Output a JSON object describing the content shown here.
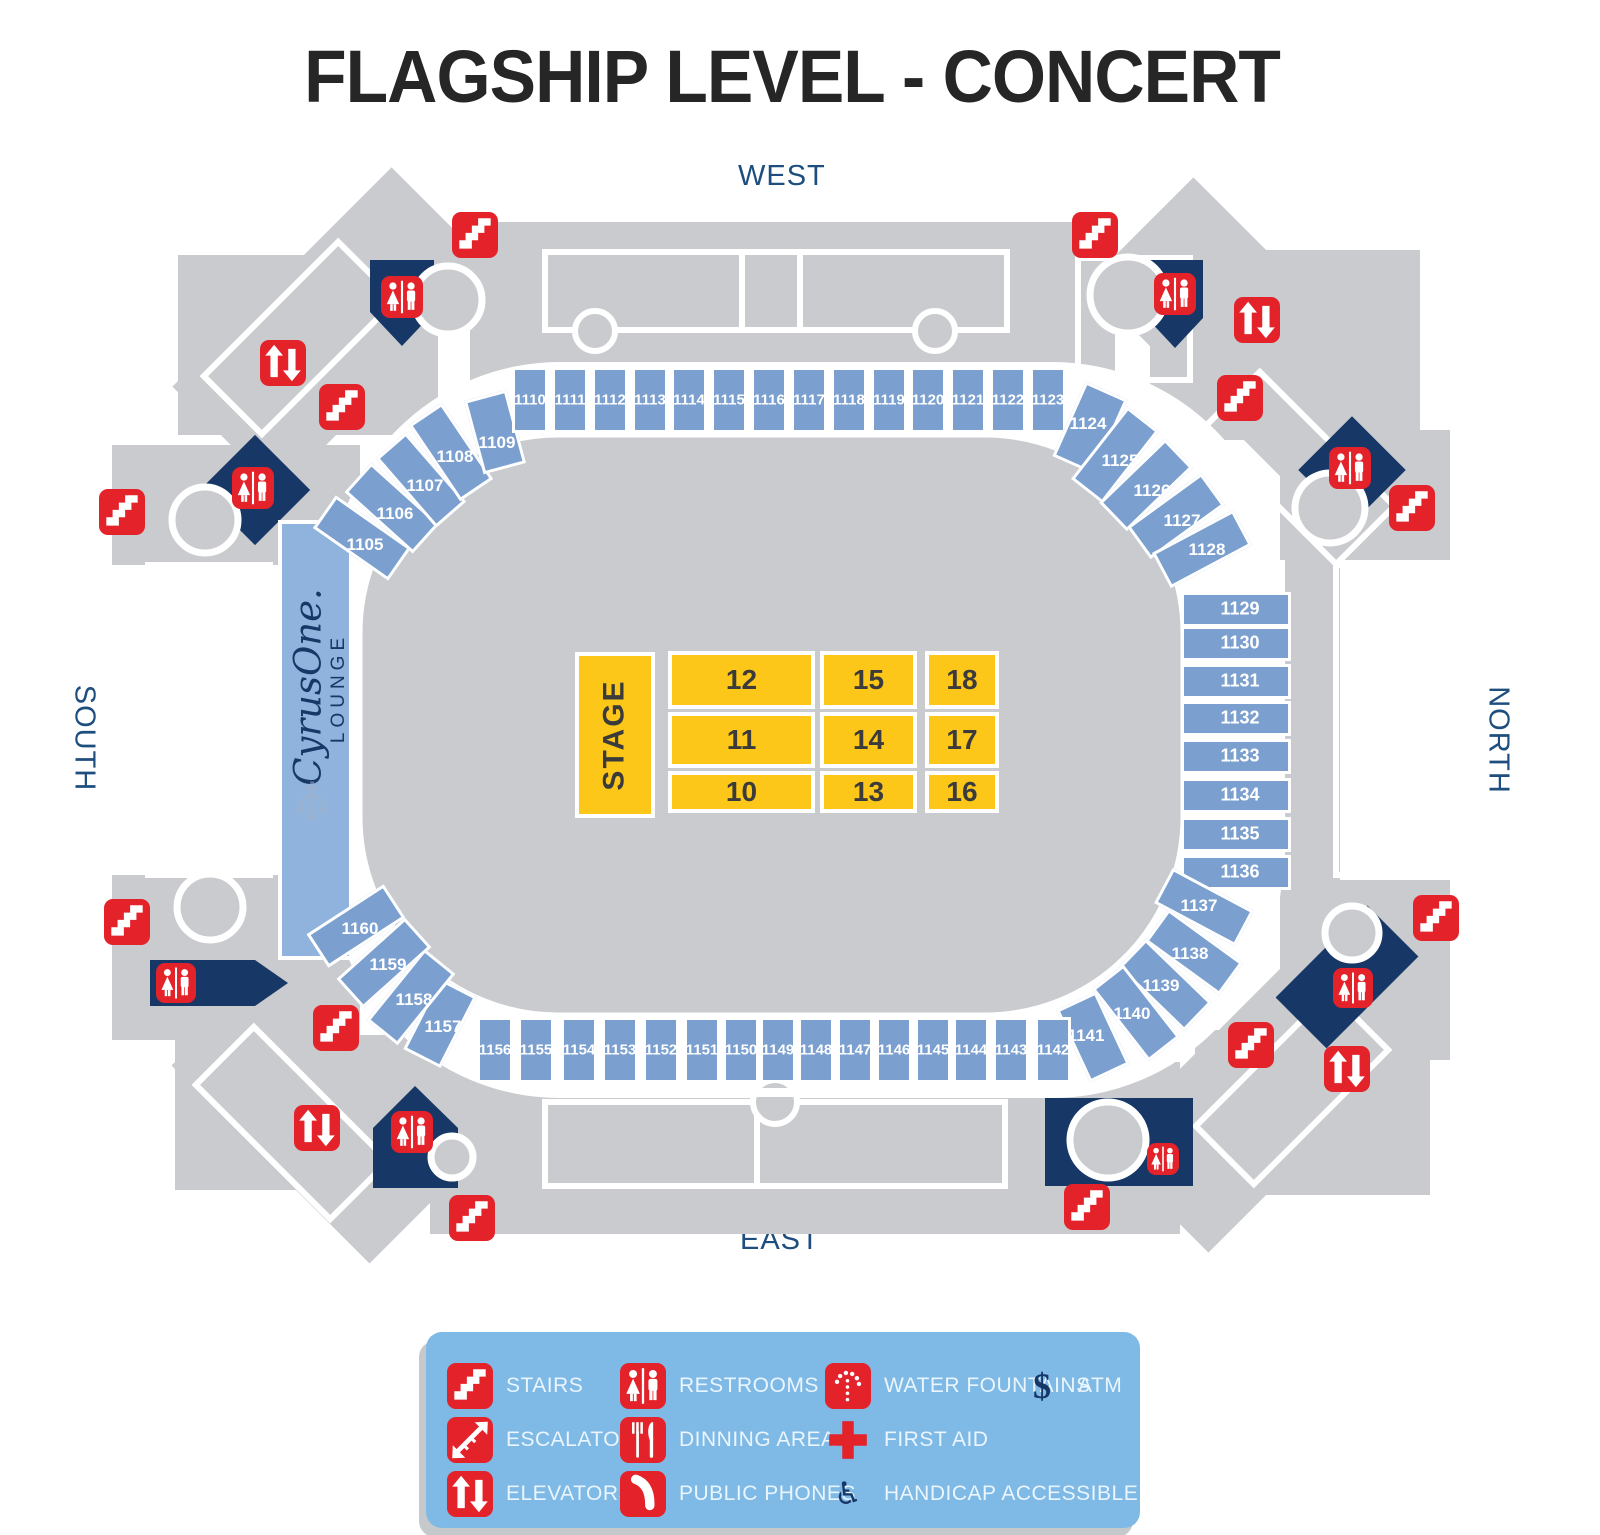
{
  "title": "FLAGSHIP LEVEL - CONCERT",
  "orientation": {
    "west": "WEST",
    "east": "EAST",
    "south": "SOUTH",
    "north": "NORTH"
  },
  "colors": {
    "section_blue": "#7BA0D0",
    "lounge_blue": "#8FB3DC",
    "concourse_gray": "#C9CBCE",
    "navy": "#173767",
    "red": "#E4222A",
    "yellow": "#FCC719",
    "legend_bg": "#7FB9E5",
    "legend_text": "#EAF5FD",
    "direction_text": "#1D4E7D",
    "title_text": "#262626",
    "floor_label": "#3B3B3B",
    "section_label": "#FFFFFF"
  },
  "lounge": {
    "brand": "CyrusOne.",
    "sub": "LOUNGE",
    "watermark_glyph": "♆",
    "watermark_icon": "trident"
  },
  "stage": {
    "label": "STAGE",
    "x": 575,
    "y": 652,
    "w": 80,
    "h": 166
  },
  "floor_grid": {
    "cols": [
      {
        "x": 668,
        "w": 147
      },
      {
        "x": 820,
        "w": 97
      },
      {
        "x": 925,
        "w": 74
      }
    ],
    "rows": [
      {
        "y": 651,
        "h": 58
      },
      {
        "y": 712,
        "h": 56
      },
      {
        "y": 771,
        "h": 42
      }
    ],
    "labels": [
      [
        "12",
        "15",
        "18"
      ],
      [
        "11",
        "14",
        "17"
      ],
      [
        "10",
        "13",
        "16"
      ]
    ]
  },
  "ring_sections": [
    {
      "n": "1105",
      "x": 362,
      "y": 538,
      "w": 40,
      "h": 92,
      "r": -55,
      "lx": 365,
      "ly": 545,
      "fs": 17
    },
    {
      "n": "1106",
      "x": 392,
      "y": 508,
      "w": 40,
      "h": 92,
      "r": -48,
      "lx": 395,
      "ly": 514,
      "fs": 17
    },
    {
      "n": "1107",
      "x": 421,
      "y": 480,
      "w": 40,
      "h": 92,
      "r": -41,
      "lx": 425,
      "ly": 486,
      "fs": 17
    },
    {
      "n": "1108",
      "x": 451,
      "y": 452,
      "w": 40,
      "h": 92,
      "r": -34,
      "lx": 455,
      "ly": 457,
      "fs": 17
    },
    {
      "n": "1109",
      "x": 495,
      "y": 432,
      "w": 44,
      "h": 76,
      "r": -15,
      "lx": 497,
      "ly": 443,
      "fs": 17
    },
    {
      "n": "1110",
      "x": 530,
      "y": 400,
      "w": 36,
      "h": 66,
      "r": 0,
      "fs": 15
    },
    {
      "n": "1111",
      "x": 570,
      "y": 400,
      "w": 36,
      "h": 66,
      "r": 0,
      "fs": 15
    },
    {
      "n": "1112",
      "x": 610,
      "y": 400,
      "w": 36,
      "h": 66,
      "r": 0,
      "fs": 15
    },
    {
      "n": "1113",
      "x": 650,
      "y": 400,
      "w": 36,
      "h": 66,
      "r": 0,
      "fs": 15
    },
    {
      "n": "1114",
      "x": 689,
      "y": 400,
      "w": 36,
      "h": 66,
      "r": 0,
      "fs": 15
    },
    {
      "n": "1115",
      "x": 729,
      "y": 400,
      "w": 36,
      "h": 66,
      "r": 0,
      "fs": 15
    },
    {
      "n": "1116",
      "x": 769,
      "y": 400,
      "w": 36,
      "h": 66,
      "r": 0,
      "fs": 15
    },
    {
      "n": "1117",
      "x": 809,
      "y": 400,
      "w": 36,
      "h": 66,
      "r": 0,
      "fs": 15
    },
    {
      "n": "1118",
      "x": 849,
      "y": 400,
      "w": 36,
      "h": 66,
      "r": 0,
      "fs": 15
    },
    {
      "n": "1119",
      "x": 889,
      "y": 400,
      "w": 36,
      "h": 66,
      "r": 0,
      "fs": 15
    },
    {
      "n": "1120",
      "x": 928,
      "y": 400,
      "w": 36,
      "h": 66,
      "r": 0,
      "fs": 15
    },
    {
      "n": "1121",
      "x": 968,
      "y": 400,
      "w": 36,
      "h": 66,
      "r": 0,
      "fs": 15
    },
    {
      "n": "1122",
      "x": 1008,
      "y": 400,
      "w": 36,
      "h": 66,
      "r": 0,
      "fs": 15
    },
    {
      "n": "1123",
      "x": 1048,
      "y": 400,
      "w": 36,
      "h": 66,
      "r": 0,
      "fs": 15
    },
    {
      "n": "1124",
      "x": 1090,
      "y": 428,
      "w": 46,
      "h": 82,
      "r": 24,
      "lx": 1088,
      "ly": 424,
      "fs": 17
    },
    {
      "n": "1125",
      "x": 1115,
      "y": 455,
      "w": 40,
      "h": 92,
      "r": 38,
      "lx": 1120,
      "ly": 461,
      "fs": 17
    },
    {
      "n": "1126",
      "x": 1146,
      "y": 485,
      "w": 40,
      "h": 92,
      "r": 46,
      "lx": 1152,
      "ly": 491,
      "fs": 17
    },
    {
      "n": "1127",
      "x": 1176,
      "y": 516,
      "w": 40,
      "h": 92,
      "r": 54,
      "lx": 1182,
      "ly": 521,
      "fs": 17
    },
    {
      "n": "1128",
      "x": 1202,
      "y": 549,
      "w": 40,
      "h": 92,
      "r": 62,
      "lx": 1207,
      "ly": 550,
      "fs": 17
    },
    {
      "n": "1129",
      "x": 1236,
      "y": 609,
      "w": 110,
      "h": 35,
      "r": 0,
      "lx": 1240,
      "fs": 18
    },
    {
      "n": "1130",
      "x": 1236,
      "y": 643,
      "w": 110,
      "h": 35,
      "r": 0,
      "lx": 1240,
      "fs": 18
    },
    {
      "n": "1131",
      "x": 1236,
      "y": 681,
      "w": 110,
      "h": 35,
      "r": 0,
      "lx": 1240,
      "fs": 18
    },
    {
      "n": "1132",
      "x": 1236,
      "y": 718,
      "w": 110,
      "h": 35,
      "r": 0,
      "lx": 1240,
      "fs": 18
    },
    {
      "n": "1133",
      "x": 1236,
      "y": 756,
      "w": 110,
      "h": 35,
      "r": 0,
      "lx": 1240,
      "fs": 18
    },
    {
      "n": "1134",
      "x": 1236,
      "y": 795,
      "w": 110,
      "h": 35,
      "r": 0,
      "lx": 1240,
      "fs": 18
    },
    {
      "n": "1135",
      "x": 1236,
      "y": 834,
      "w": 110,
      "h": 35,
      "r": 0,
      "lx": 1240,
      "fs": 18
    },
    {
      "n": "1136",
      "x": 1236,
      "y": 872,
      "w": 110,
      "h": 35,
      "r": 0,
      "lx": 1240,
      "fs": 18
    },
    {
      "n": "1137",
      "x": 1204,
      "y": 907,
      "w": 40,
      "h": 92,
      "r": -62,
      "lx": 1199,
      "ly": 906,
      "fs": 17
    },
    {
      "n": "1138",
      "x": 1194,
      "y": 952,
      "w": 40,
      "h": 92,
      "r": -54,
      "lx": 1190,
      "ly": 954,
      "fs": 17
    },
    {
      "n": "1139",
      "x": 1165,
      "y": 985,
      "w": 40,
      "h": 92,
      "r": -46,
      "lx": 1161,
      "ly": 986,
      "fs": 17
    },
    {
      "n": "1140",
      "x": 1136,
      "y": 1013,
      "w": 40,
      "h": 92,
      "r": -38,
      "lx": 1132,
      "ly": 1014,
      "fs": 17
    },
    {
      "n": "1141",
      "x": 1093,
      "y": 1037,
      "w": 44,
      "h": 80,
      "r": -25,
      "lx": 1086,
      "ly": 1036,
      "fs": 17
    },
    {
      "n": "1142",
      "x": 1053,
      "y": 1050,
      "w": 36,
      "h": 66,
      "r": 0,
      "fs": 15
    },
    {
      "n": "1143",
      "x": 1011,
      "y": 1050,
      "w": 36,
      "h": 66,
      "r": 0,
      "fs": 15
    },
    {
      "n": "1144",
      "x": 971,
      "y": 1050,
      "w": 36,
      "h": 66,
      "r": 0,
      "fs": 15
    },
    {
      "n": "1145",
      "x": 933,
      "y": 1050,
      "w": 36,
      "h": 66,
      "r": 0,
      "fs": 15
    },
    {
      "n": "1146",
      "x": 894,
      "y": 1050,
      "w": 36,
      "h": 66,
      "r": 0,
      "fs": 15
    },
    {
      "n": "1147",
      "x": 855,
      "y": 1050,
      "w": 36,
      "h": 66,
      "r": 0,
      "fs": 15
    },
    {
      "n": "1148",
      "x": 816,
      "y": 1050,
      "w": 36,
      "h": 66,
      "r": 0,
      "fs": 15
    },
    {
      "n": "1149",
      "x": 778,
      "y": 1050,
      "w": 36,
      "h": 66,
      "r": 0,
      "fs": 15
    },
    {
      "n": "1150",
      "x": 741,
      "y": 1050,
      "w": 36,
      "h": 66,
      "r": 0,
      "fs": 15
    },
    {
      "n": "1151",
      "x": 702,
      "y": 1050,
      "w": 36,
      "h": 66,
      "r": 0,
      "fs": 15
    },
    {
      "n": "1152",
      "x": 661,
      "y": 1050,
      "w": 36,
      "h": 66,
      "r": 0,
      "fs": 15
    },
    {
      "n": "1153",
      "x": 620,
      "y": 1050,
      "w": 36,
      "h": 66,
      "r": 0,
      "fs": 15
    },
    {
      "n": "1154",
      "x": 579,
      "y": 1050,
      "w": 36,
      "h": 66,
      "r": 0,
      "fs": 15
    },
    {
      "n": "1155",
      "x": 536,
      "y": 1050,
      "w": 36,
      "h": 66,
      "r": 0,
      "fs": 15
    },
    {
      "n": "1156",
      "x": 495,
      "y": 1050,
      "w": 36,
      "h": 66,
      "r": 0,
      "fs": 15
    },
    {
      "n": "1157",
      "x": 440,
      "y": 1023,
      "w": 42,
      "h": 80,
      "r": 27,
      "lx": 443,
      "ly": 1027,
      "fs": 17
    },
    {
      "n": "1158",
      "x": 411,
      "y": 997,
      "w": 40,
      "h": 92,
      "r": 39,
      "lx": 414,
      "ly": 1000,
      "fs": 17
    },
    {
      "n": "1159",
      "x": 384,
      "y": 963,
      "w": 40,
      "h": 92,
      "r": 48,
      "lx": 388,
      "ly": 965,
      "fs": 17
    },
    {
      "n": "1160",
      "x": 356,
      "y": 926,
      "w": 40,
      "h": 92,
      "r": 57,
      "lx": 360,
      "ly": 929,
      "fs": 17
    }
  ],
  "map_icons": [
    {
      "type": "stairs",
      "x": 475,
      "y": 235
    },
    {
      "type": "stairs",
      "x": 1095,
      "y": 235
    },
    {
      "type": "stairs",
      "x": 342,
      "y": 407
    },
    {
      "type": "stairs",
      "x": 1240,
      "y": 398
    },
    {
      "type": "stairs",
      "x": 122,
      "y": 512
    },
    {
      "type": "stairs",
      "x": 1412,
      "y": 508
    },
    {
      "type": "stairs",
      "x": 127,
      "y": 922
    },
    {
      "type": "stairs",
      "x": 1436,
      "y": 918
    },
    {
      "type": "stairs",
      "x": 336,
      "y": 1028
    },
    {
      "type": "stairs",
      "x": 1251,
      "y": 1045
    },
    {
      "type": "stairs",
      "x": 472,
      "y": 1218
    },
    {
      "type": "stairs",
      "x": 1087,
      "y": 1207
    },
    {
      "type": "elevators",
      "x": 283,
      "y": 363
    },
    {
      "type": "elevators",
      "x": 1257,
      "y": 320
    },
    {
      "type": "elevators",
      "x": 317,
      "y": 1128
    },
    {
      "type": "elevators",
      "x": 1347,
      "y": 1069
    },
    {
      "type": "restrooms",
      "x": 402,
      "y": 297,
      "s": 42
    },
    {
      "type": "restrooms",
      "x": 253,
      "y": 488,
      "s": 42
    },
    {
      "type": "restrooms",
      "x": 176,
      "y": 983,
      "s": 40
    },
    {
      "type": "restrooms",
      "x": 412,
      "y": 1132,
      "s": 42
    },
    {
      "type": "restrooms",
      "x": 1175,
      "y": 294,
      "s": 42
    },
    {
      "type": "restrooms",
      "x": 1350,
      "y": 468,
      "s": 42
    },
    {
      "type": "restrooms",
      "x": 1353,
      "y": 988,
      "s": 40
    },
    {
      "type": "restrooms",
      "x": 1163,
      "y": 1159,
      "s": 32
    }
  ],
  "legend": {
    "x": 426,
    "y": 1332,
    "w": 714,
    "h": 196,
    "col_x": [
      470,
      643,
      848,
      1042
    ],
    "row_y": [
      1386,
      1440,
      1494
    ],
    "items": [
      {
        "icon": "stairs",
        "label": "STAIRS",
        "col": 0,
        "row": 0
      },
      {
        "icon": "restrooms",
        "label": "RESTROOMS",
        "col": 1,
        "row": 0
      },
      {
        "icon": "water-fountains",
        "label": "WATER FOUNTAINS",
        "col": 2,
        "row": 0
      },
      {
        "icon": "atm",
        "label": "ATM",
        "col": 3,
        "row": 0
      },
      {
        "icon": "escalators",
        "label": "ESCALATORS",
        "col": 0,
        "row": 1
      },
      {
        "icon": "dining",
        "label": "DINNING AREA",
        "col": 1,
        "row": 1
      },
      {
        "icon": "first-aid",
        "label": "FIRST AID",
        "col": 2,
        "row": 1
      },
      {
        "icon": "elevators",
        "label": "ELEVATORS",
        "col": 0,
        "row": 2
      },
      {
        "icon": "phones",
        "label": "PUBLIC PHONES",
        "col": 1,
        "row": 2
      },
      {
        "icon": "handicap",
        "label": "HANDICAP ACCESSIBLE",
        "col": 2,
        "row": 2
      }
    ]
  }
}
